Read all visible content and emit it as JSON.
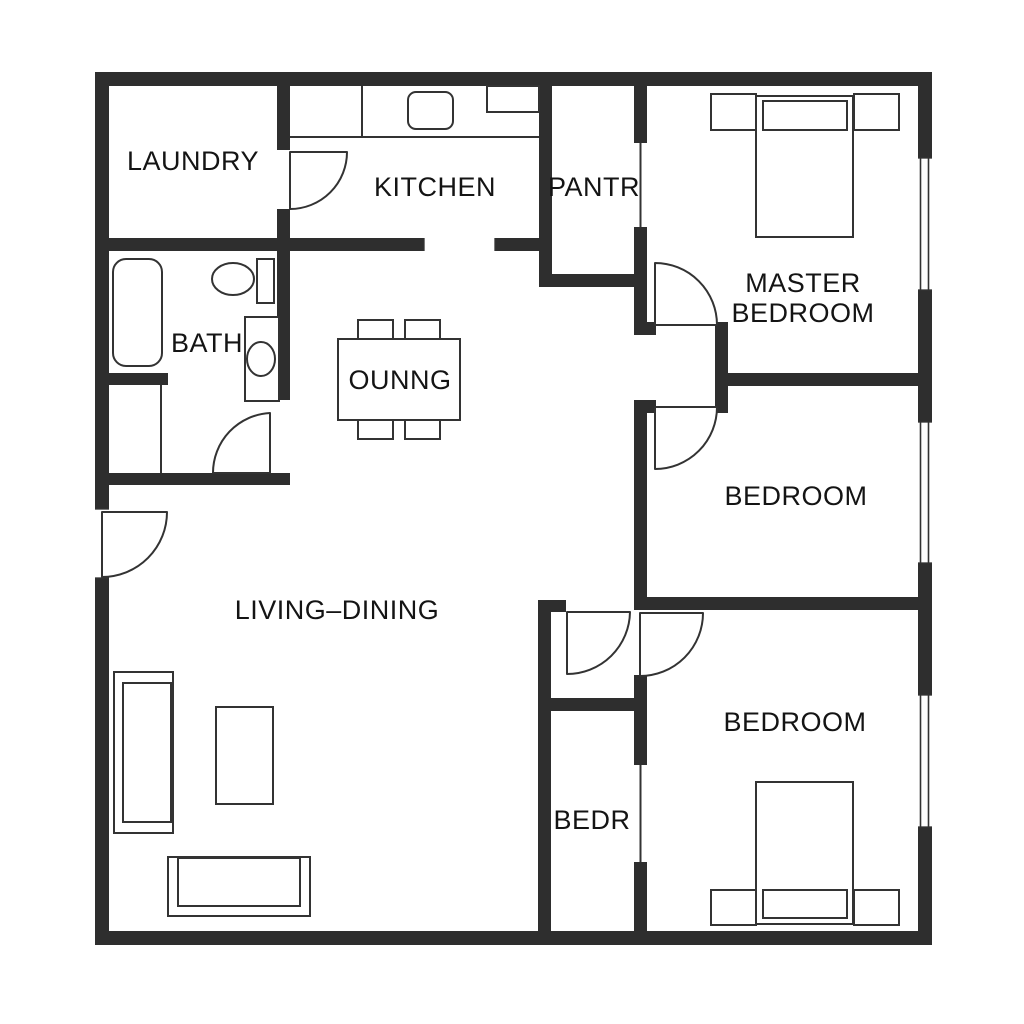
{
  "plan": {
    "title": "floor-plan",
    "colors": {
      "wall": "#2e2e2e",
      "line": "#333333",
      "background": "#ffffff",
      "text": "#141414"
    },
    "rooms": [
      {
        "id": "laundry",
        "label": "LAUNDRY"
      },
      {
        "id": "kitchen",
        "label": "KITCHEN"
      },
      {
        "id": "pantry",
        "label": "PANTR"
      },
      {
        "id": "master-bedroom",
        "label_line1": "MASTER",
        "label_line2": "BEDROOM"
      },
      {
        "id": "bath",
        "label": "BATH"
      },
      {
        "id": "dining-table",
        "label": "OUNNG"
      },
      {
        "id": "bedroom-middle",
        "label": "BEDROOM"
      },
      {
        "id": "living-dining",
        "label": "LIVING–DINING"
      },
      {
        "id": "bedroom-bottom",
        "label": "BEDROOM"
      },
      {
        "id": "bedroom-small",
        "label": "BEDR"
      }
    ]
  }
}
